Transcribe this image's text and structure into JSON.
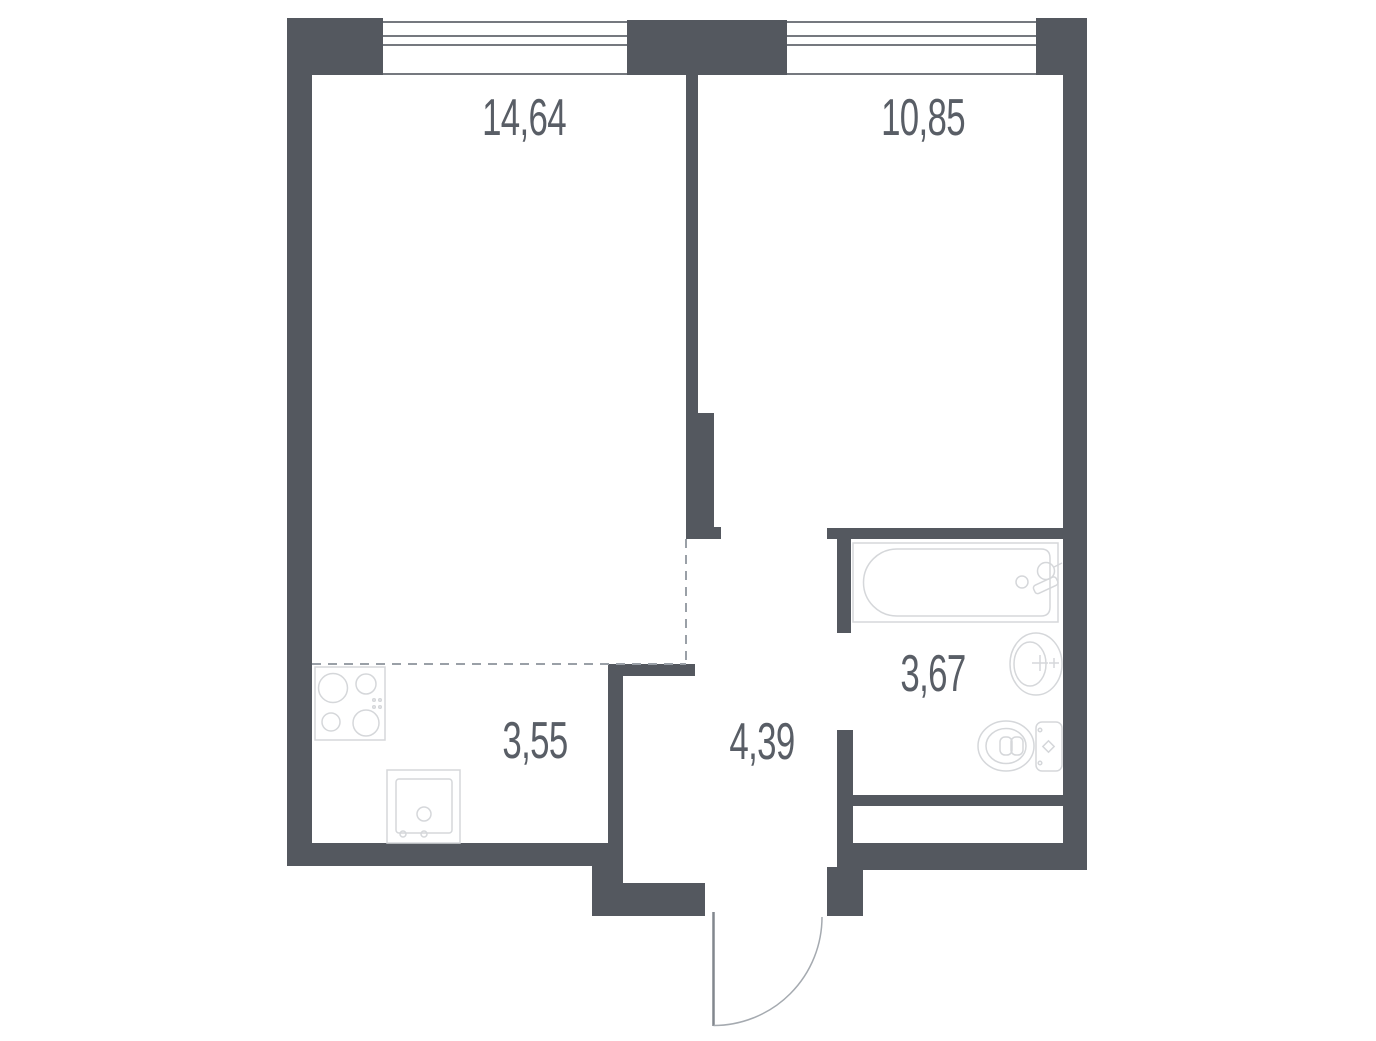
{
  "floor_plan": {
    "rooms": [
      {
        "name": "living-room",
        "area_m2": "14,64"
      },
      {
        "name": "bedroom",
        "area_m2": "10,85"
      },
      {
        "name": "bathroom",
        "area_m2": "3,67"
      },
      {
        "name": "kitchen",
        "area_m2": "3,55"
      },
      {
        "name": "hallway",
        "area_m2": "4,39"
      }
    ],
    "fixtures": [
      "bathtub",
      "washbasin",
      "toilet",
      "cooktop",
      "kitchen-sink",
      "entrance-door",
      "window"
    ],
    "colors": {
      "wall": "#54585f",
      "label_text": "#595e66",
      "fixture_line": "#d5d7da",
      "dashed_line": "#9aa0a7",
      "window_line": "#75797f",
      "door_leaf": "#82878e",
      "door_arc": "#a5aab0",
      "background": "#ffffff"
    }
  }
}
